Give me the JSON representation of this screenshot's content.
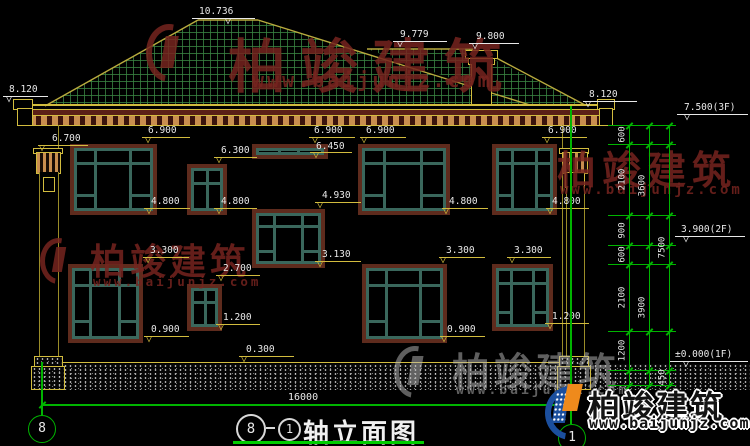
{
  "colors": {
    "background": "#000000",
    "line_green": "#00b400",
    "line_yellow": "#d2bc3e",
    "line_olive": "#b9ab3e",
    "text_white": "#e8e8e8",
    "roof_grid": "#3a8442",
    "window_frame": "#3a675c",
    "window_trim": "#5e2b1d",
    "dentil_tan": "#c98e4f",
    "band_maroon": "#5a1f16",
    "watermark_red": "#76241f",
    "watermark_gray": "#bdbdbd",
    "logo_blue": "#1b4f9e",
    "logo_orange": "#ef8a1c"
  },
  "drawing_title": {
    "bubble_left": "8",
    "separator": "-",
    "bubble_right": "1",
    "name": "轴立面图"
  },
  "axis_bubbles": {
    "left": "8",
    "right": "1"
  },
  "bottom_dimension": {
    "total_width": "16000"
  },
  "elevation_marks": [
    {
      "label": "10.736",
      "tx": 199,
      "ty": 6,
      "lx": 192,
      "lw": 63,
      "ly": 18,
      "ax": 230,
      "c": "w"
    },
    {
      "label": "9.779",
      "tx": 400,
      "ty": 29,
      "lx": 393,
      "lw": 54,
      "ly": 41,
      "ax": 402,
      "c": "w"
    },
    {
      "label": "9.800",
      "tx": 476,
      "ty": 31,
      "lx": 469,
      "lw": 50,
      "ly": 43,
      "ax": 477,
      "c": "w"
    },
    {
      "label": "8.120",
      "tx": 9,
      "ty": 84,
      "lx": 3,
      "lw": 45,
      "ly": 96,
      "ax": 11,
      "c": "w"
    },
    {
      "label": "8.120",
      "tx": 589,
      "ty": 89,
      "lx": 583,
      "lw": 54,
      "ly": 101,
      "ax": 590,
      "c": "w"
    },
    {
      "label": "7.500(3F)",
      "tx": 684,
      "ty": 102,
      "lx": 677,
      "lw": 71,
      "ly": 114,
      "ax": 689,
      "c": "w"
    },
    {
      "label": "3.900(2F)",
      "tx": 681,
      "ty": 224,
      "lx": 675,
      "lw": 70,
      "ly": 236,
      "ax": 688,
      "c": "w"
    },
    {
      "label": "±0.000(1F)",
      "tx": 675,
      "ty": 349,
      "lx": 670,
      "lw": 78,
      "ly": 361,
      "ax": 688,
      "c": "w"
    },
    {
      "label": "6.700",
      "tx": 52,
      "ty": 133,
      "lx": 38,
      "lw": 50,
      "ly": 145,
      "ax": 44,
      "c": "y"
    },
    {
      "label": "6.900",
      "tx": 148,
      "ty": 125,
      "lx": 142,
      "lw": 48,
      "ly": 137,
      "ax": 150,
      "c": "y"
    },
    {
      "label": "6.900",
      "tx": 314,
      "ty": 125,
      "lx": 309,
      "lw": 46,
      "ly": 137,
      "ax": 317,
      "c": "y"
    },
    {
      "label": "6.900",
      "tx": 366,
      "ty": 125,
      "lx": 360,
      "lw": 46,
      "ly": 137,
      "ax": 366,
      "c": "y"
    },
    {
      "label": "6.900",
      "tx": 548,
      "ty": 125,
      "lx": 542,
      "lw": 45,
      "ly": 137,
      "ax": 549,
      "c": "y"
    },
    {
      "label": "6.450",
      "tx": 316,
      "ty": 141,
      "lx": 310,
      "lw": 42,
      "ly": 152,
      "ax": 318,
      "c": "y"
    },
    {
      "label": "6.300",
      "tx": 221,
      "ty": 145,
      "lx": 214,
      "lw": 43,
      "ly": 157,
      "ax": 221,
      "c": "y"
    },
    {
      "label": "4.930",
      "tx": 322,
      "ty": 190,
      "lx": 315,
      "lw": 46,
      "ly": 202,
      "ax": 322,
      "c": "y"
    },
    {
      "label": "4.800",
      "tx": 151,
      "ty": 196,
      "lx": 144,
      "lw": 46,
      "ly": 208,
      "ax": 151,
      "c": "y"
    },
    {
      "label": "4.800",
      "tx": 221,
      "ty": 196,
      "lx": 214,
      "lw": 43,
      "ly": 208,
      "ax": 221,
      "c": "y"
    },
    {
      "label": "4.800",
      "tx": 449,
      "ty": 196,
      "lx": 442,
      "lw": 46,
      "ly": 208,
      "ax": 448,
      "c": "y"
    },
    {
      "label": "4.800",
      "tx": 552,
      "ty": 196,
      "lx": 546,
      "lw": 43,
      "ly": 208,
      "ax": 552,
      "c": "y"
    },
    {
      "label": "3.300",
      "tx": 150,
      "ty": 245,
      "lx": 143,
      "lw": 46,
      "ly": 257,
      "ax": 150,
      "c": "y"
    },
    {
      "label": "3.300",
      "tx": 446,
      "ty": 245,
      "lx": 439,
      "lw": 46,
      "ly": 257,
      "ax": 445,
      "c": "y"
    },
    {
      "label": "3.300",
      "tx": 514,
      "ty": 245,
      "lx": 507,
      "lw": 44,
      "ly": 257,
      "ax": 514,
      "c": "y"
    },
    {
      "label": "3.130",
      "tx": 322,
      "ty": 249,
      "lx": 315,
      "lw": 46,
      "ly": 261,
      "ax": 322,
      "c": "y"
    },
    {
      "label": "2.700",
      "tx": 223,
      "ty": 263,
      "lx": 216,
      "lw": 44,
      "ly": 275,
      "ax": 223,
      "c": "y"
    },
    {
      "label": "1.200",
      "tx": 223,
      "ty": 312,
      "lx": 216,
      "lw": 44,
      "ly": 324,
      "ax": 223,
      "c": "y"
    },
    {
      "label": "1.200",
      "tx": 552,
      "ty": 311,
      "lx": 545,
      "lw": 44,
      "ly": 323,
      "ax": 552,
      "c": "y"
    },
    {
      "label": "0.900",
      "tx": 151,
      "ty": 324,
      "lx": 144,
      "lw": 45,
      "ly": 336,
      "ax": 151,
      "c": "y"
    },
    {
      "label": "0.900",
      "tx": 447,
      "ty": 324,
      "lx": 440,
      "lw": 45,
      "ly": 336,
      "ax": 446,
      "c": "y"
    },
    {
      "label": "0.300",
      "tx": 246,
      "ty": 344,
      "lx": 239,
      "lw": 55,
      "ly": 356,
      "ax": 246,
      "c": "y"
    }
  ],
  "right_dimension_chain": {
    "vertical_lines": [
      {
        "x": 629,
        "y1": 125,
        "y2": 385
      },
      {
        "x": 649,
        "y1": 125,
        "y2": 385
      },
      {
        "x": 669,
        "y1": 125,
        "y2": 385
      }
    ],
    "level_lines_y": [
      125,
      144,
      215,
      245,
      264,
      331,
      370,
      385
    ],
    "level_line_x1": 608,
    "level_line_x2": 676,
    "labels": [
      {
        "label": "600",
        "x": 629,
        "cy": 134
      },
      {
        "label": "2100",
        "x": 629,
        "cy": 179
      },
      {
        "label": "900",
        "x": 629,
        "cy": 230
      },
      {
        "label": "600",
        "x": 629,
        "cy": 254
      },
      {
        "label": "2100",
        "x": 629,
        "cy": 297
      },
      {
        "label": "1200",
        "x": 629,
        "cy": 350
      },
      {
        "label": "3600",
        "x": 649,
        "cy": 185
      },
      {
        "label": "3900",
        "x": 649,
        "cy": 307
      },
      {
        "label": "7500",
        "x": 669,
        "cy": 247
      },
      {
        "label": "450",
        "x": 669,
        "cy": 377
      }
    ]
  },
  "windows": [
    {
      "x": 70,
      "y": 144,
      "w": 87,
      "h": 71,
      "type": "big"
    },
    {
      "x": 187,
      "y": 164,
      "w": 40,
      "h": 51,
      "type": "quad"
    },
    {
      "x": 252,
      "y": 144,
      "w": 76,
      "h": 15,
      "type": "strip"
    },
    {
      "x": 358,
      "y": 144,
      "w": 92,
      "h": 71,
      "type": "big"
    },
    {
      "x": 492,
      "y": 144,
      "w": 65,
      "h": 71,
      "type": "big"
    },
    {
      "x": 252,
      "y": 209,
      "w": 73,
      "h": 59,
      "type": "big"
    },
    {
      "x": 68,
      "y": 264,
      "w": 75,
      "h": 79,
      "type": "big"
    },
    {
      "x": 187,
      "y": 284,
      "w": 35,
      "h": 47,
      "type": "quad"
    },
    {
      "x": 362,
      "y": 264,
      "w": 85,
      "h": 79,
      "type": "big"
    },
    {
      "x": 492,
      "y": 264,
      "w": 61,
      "h": 67,
      "type": "big"
    }
  ],
  "watermarks": {
    "company": "柏竣建筑",
    "website": "www.baijunjz.com",
    "instances": [
      {
        "style": "red",
        "cx": 228,
        "cy": 20,
        "fs": 58,
        "ls": 14,
        "ux": 252,
        "uy": 68,
        "ufs": 20,
        "icon": {
          "x": 146,
          "y": 24,
          "s": 58
        }
      },
      {
        "style": "red",
        "cx": 90,
        "cy": 233,
        "fs": 36,
        "ls": 4,
        "ux": 93,
        "uy": 274,
        "ufs": 12.5,
        "icon": {
          "x": 40,
          "y": 238,
          "s": 46
        }
      },
      {
        "style": "red",
        "cx": 557,
        "cy": 140,
        "fs": 39,
        "ls": 6,
        "ux": 560,
        "uy": 182,
        "ufs": 14,
        "icon": null
      },
      {
        "style": "gray",
        "cx": 452,
        "cy": 341,
        "fs": 38,
        "ls": 4,
        "ux": 456,
        "uy": 383,
        "ufs": 13,
        "icon": {
          "x": 394,
          "y": 346,
          "s": 52
        }
      }
    ]
  },
  "logo": {
    "company": "柏竣建筑",
    "website": "www.baijunjz.com"
  }
}
